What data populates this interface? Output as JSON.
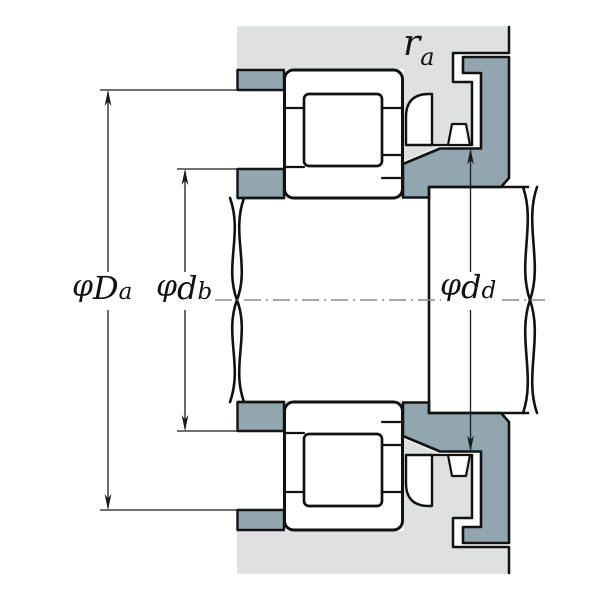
{
  "diagram": {
    "kind": "bearing-mounting-cross-section",
    "labels": {
      "Da": {
        "phi": "φ",
        "main": "D",
        "sub": "a"
      },
      "db": {
        "phi": "φ",
        "main": "d",
        "sub": "b"
      },
      "dd": {
        "phi": "φ",
        "main": "d",
        "sub": "d"
      },
      "ra": {
        "main": "r",
        "sub": "a"
      }
    },
    "colors": {
      "housing": "#dfe0e0",
      "spacer": "#92a6b0",
      "part_fill": "#ffffff",
      "outline": "#121212",
      "dimension": "#1a1a1a",
      "centerline": "#8c8c8c",
      "background": "#ffffff"
    }
  }
}
